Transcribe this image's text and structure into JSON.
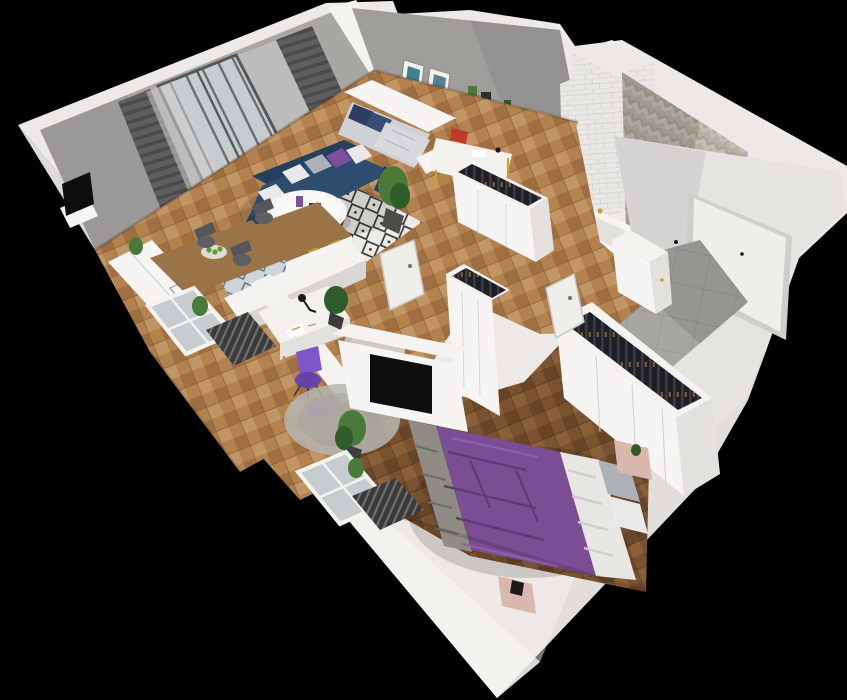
{
  "scene": {
    "kind": "3d-cutaway-apartment-floorplan",
    "background": "#000000"
  },
  "colors": {
    "wallTop": "#ece9e6",
    "wallFace": "#f4f3f0",
    "wallShade": "#d9d6d3",
    "wallInner": "#e6e4e1",
    "grayWall": "#a9a7a4",
    "grayWall2": "#a09e9b",
    "curtain": "#5e5e5e",
    "curtainDark": "#4a4a4a",
    "sheer": "#cdcdcd",
    "glass": "#c7ccce",
    "railing": "#6d6d6d",
    "floorLightA": "#b3824f",
    "floorLightB": "#a06f41",
    "floorLightC": "#c29565",
    "floorDarkA": "#7a522f",
    "floorDarkB": "#694527",
    "floorDarkC": "#8a603a",
    "tileBlueBg": "#ccd5d9",
    "tileBlueInk": "#4f7790",
    "tileGray": "#a7a6a3",
    "tileGrout": "#959492",
    "subway": "#e9e8e5",
    "subwayLine": "#d2d1ce",
    "chevronA": "#b7b0a4",
    "chevronB": "#c6c0b4",
    "chevronC": "#a8a195",
    "rugBg": "#edebe5",
    "rugInk": "#343434",
    "rugGray": "#b7b5b0",
    "rugGrayEdge": "#a5a39e",
    "sofaBlue": "#2e4c6d",
    "sofaBlueDark": "#25405c",
    "pillowWhite": "#e9e9e9",
    "pillowGray": "#aeb0b8",
    "pillowPurple": "#7c4f9e",
    "woodFurn": "#9a7347",
    "white": "#f6f5f3",
    "offWhite": "#e3e1de",
    "bedPurple": "#7b4d95",
    "bedPurpleDark": "#5f3a75",
    "bedPurpleLite": "#8d5fab",
    "blanketWhite": "#e8e7e4",
    "blanketGray": "#8f8c86",
    "nightPink": "#d9b8ad",
    "deskWhite": "#f2f1ee",
    "gold": "#c9a227",
    "chairPurple": "#7d57c9",
    "chairPurpleDark": "#6343a8",
    "plantGreen": "#4a7a3a",
    "plantDark": "#2f5c2a",
    "clothesDark": "#1e1f26",
    "clothesBar": "#3a3b44",
    "hanger": "#8a5f2e",
    "tvBlack": "#0e0e10",
    "radiatorDark": "#3a3a3a",
    "radiatorLite": "#6f6f6f",
    "doorWhite": "#efeeeb",
    "doorFrame": "#cfcecb",
    "hardware": "#1a1a1a",
    "artTeal": "#3f7f8f",
    "artBlue": "#5a7f95",
    "redBox": "#c0392b",
    "appleGreen": "#5f9e2f",
    "shadow": "#000000"
  }
}
